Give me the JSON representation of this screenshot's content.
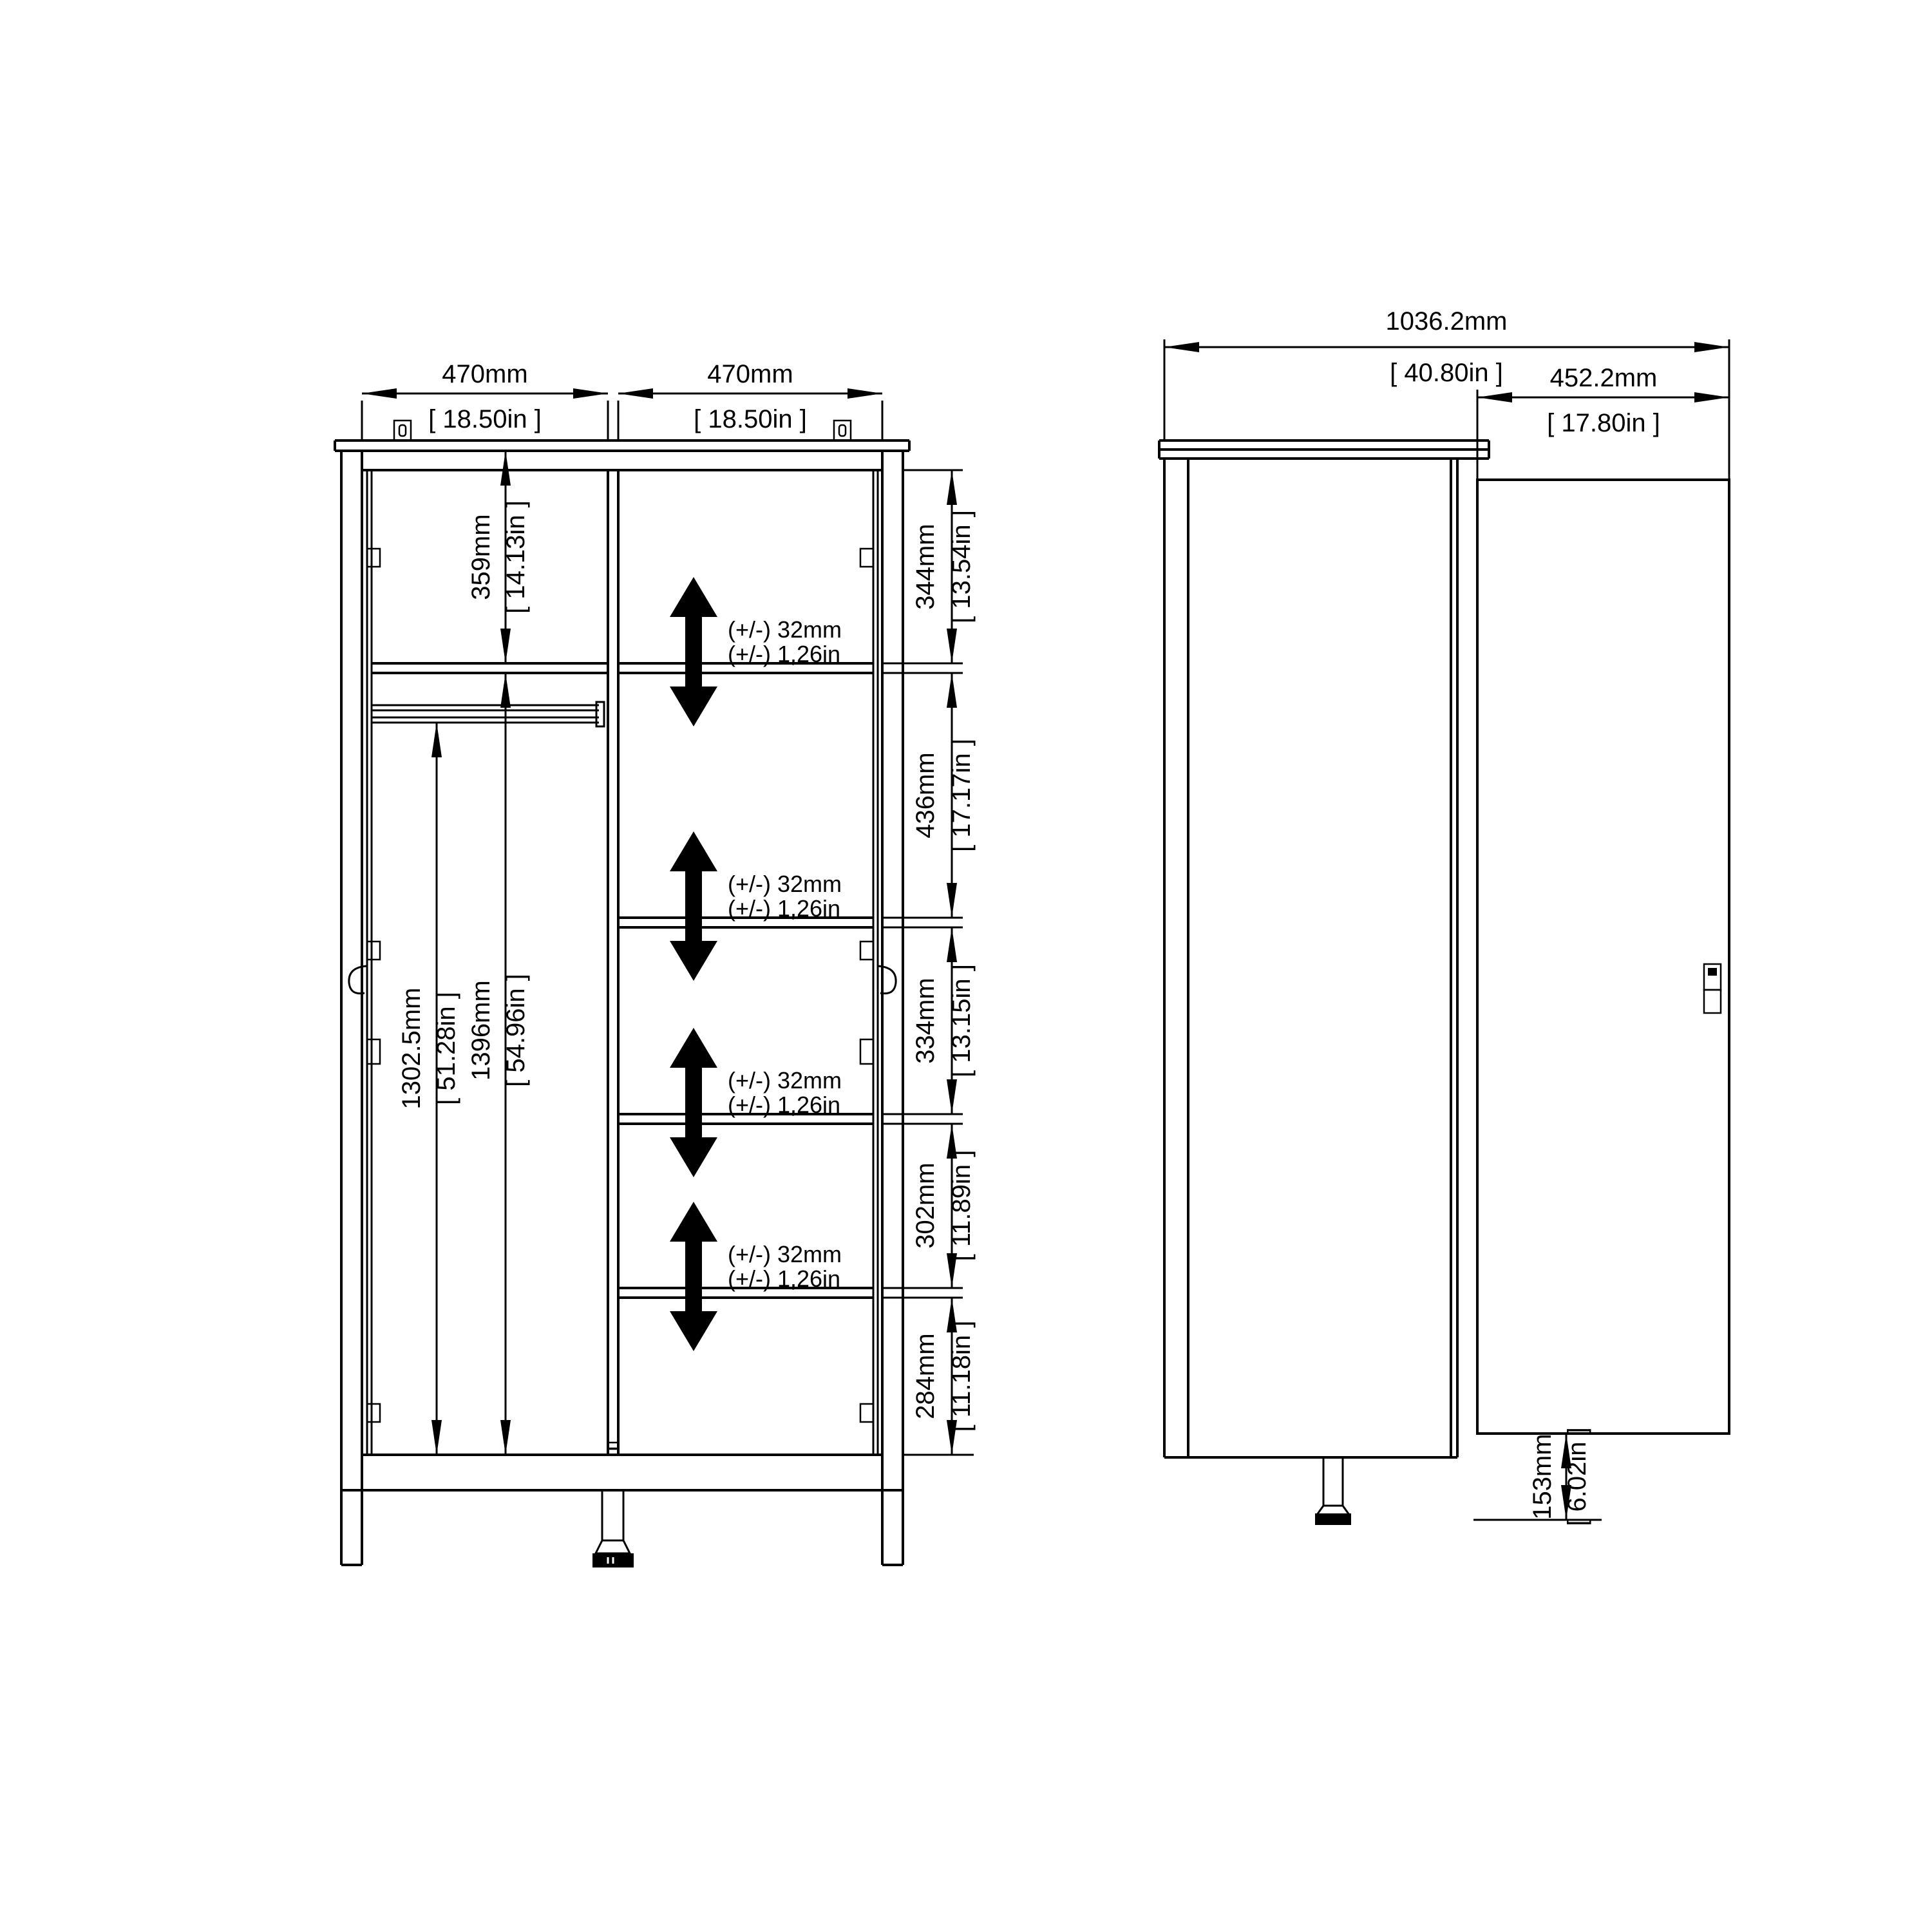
{
  "front_view": {
    "width_dims": [
      {
        "mm": "470mm",
        "in": "[ 18.50in ]"
      },
      {
        "mm": "470mm",
        "in": "[ 18.50in ]"
      }
    ],
    "interior_dims": {
      "upper_shelf_depth": {
        "mm": "359mm",
        "in": "[ 14.13in ]"
      },
      "rail_to_bottom": {
        "mm": "1302.5mm",
        "in": "[ 51.28in ]"
      },
      "shelf_to_bottom": {
        "mm": "1396mm",
        "in": "[ 54.96in ]"
      }
    },
    "shelf_spacings": [
      {
        "mm": "344mm",
        "in": "[ 13.54in ]"
      },
      {
        "mm": "436mm",
        "in": "[ 17.17in ]"
      },
      {
        "mm": "334mm",
        "in": "[ 13.15in ]"
      },
      {
        "mm": "302mm",
        "in": "[ 11.89in ]"
      },
      {
        "mm": "284mm",
        "in": "[ 11.18in ]"
      }
    ],
    "adjustable_notes": [
      {
        "mm": "(+/-) 32mm",
        "in": "(+/-) 1,26in"
      },
      {
        "mm": "(+/-) 32mm",
        "in": "(+/-) 1,26in"
      },
      {
        "mm": "(+/-) 32mm",
        "in": "(+/-) 1,26in"
      },
      {
        "mm": "(+/-) 32mm",
        "in": "(+/-) 1,26in"
      }
    ]
  },
  "side_view": {
    "overall_depth": {
      "mm": "1036.2mm",
      "in": "[ 40.80in ]"
    },
    "door_width": {
      "mm": "452.2mm",
      "in": "[ 17.80in ]"
    },
    "door_to_floor": {
      "mm": "153mm",
      "in": "[ 6.02in ]"
    }
  }
}
